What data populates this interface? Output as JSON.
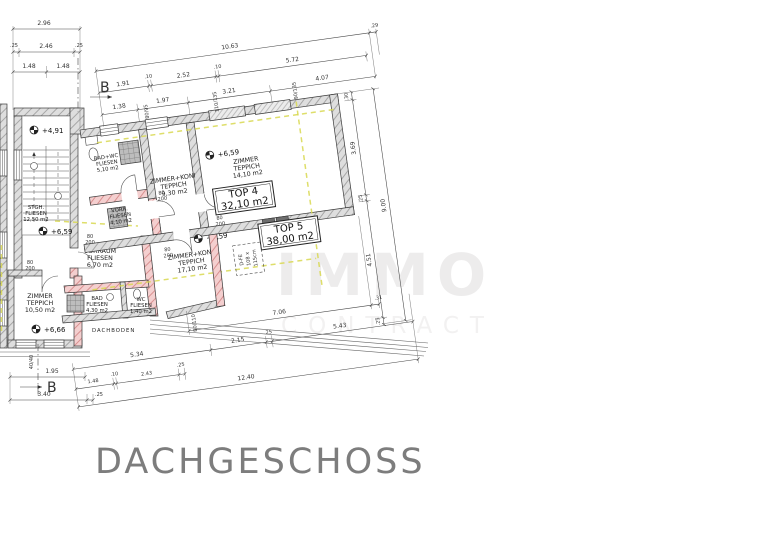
{
  "title": "DACHGESCHOSS",
  "watermark": {
    "line1": "IMMO",
    "line2": "CONTRACT"
  },
  "section_marker": "B",
  "tops": {
    "top4": {
      "label": "TOP 4",
      "area": "32,10 m2"
    },
    "top5": {
      "label": "TOP 5",
      "area": "38,00 m2"
    }
  },
  "rooms": {
    "stgh": [
      "STGH.",
      "FLIESEN",
      "12,50 m2"
    ],
    "badwc": [
      "BAD+WC",
      "FLIESEN",
      "5,10 m2"
    ],
    "zk930": [
      "ZIMMER+KONI",
      "TEPPICH",
      "9,30 m2"
    ],
    "z1410": [
      "ZIMMER",
      "TEPPICH",
      "14,10 m2"
    ],
    "vorr": [
      "VORR.",
      "FLIESEN",
      "4,10 m2"
    ],
    "vorraum": [
      "VORRAUM",
      "FLIESEN",
      "6,70 m2"
    ],
    "bad": [
      "BAD",
      "FLIESEN",
      "4,30 m2"
    ],
    "wc": [
      "WC",
      "FLIESEN",
      "1,40 m2"
    ],
    "z1050": [
      "ZIMMER",
      "TEPPICH",
      "10,50 m2"
    ],
    "zk1710": [
      "ZIMMER+KONI",
      "TEPPICH",
      "17,10 m2"
    ],
    "dachboden": "DACHBODEN"
  },
  "levels": {
    "l491": "+4,91",
    "l659": "+6,59",
    "l666": "+6,66"
  },
  "door_label": {
    "w": "80",
    "h": "200"
  },
  "roof_window": [
    "D-FE",
    "108 x",
    "115cm"
  ],
  "stacked": {
    "s1": "80/95",
    "s2": "110/135",
    "s3": "90/135",
    "s4": "80/110",
    "s5": "40/40"
  },
  "dims": {
    "tl1": "2.96",
    "tl2a": ".25",
    "tl2b": "2.46",
    "tl2c": ".25",
    "tl3a": "1.48",
    "tl3b": "1.48",
    "t1a": "10.63",
    "t1b": ".29",
    "t2": [
      "1.91",
      ".10",
      "2.52",
      ".10",
      "5.72"
    ],
    "t3": [
      "1.38",
      "1.97",
      "3.21",
      "4.07"
    ],
    "r1": [
      ".30",
      "3.69",
      ".25",
      "4.51",
      ".25"
    ],
    "r2": "9.00",
    "b1a": "7.06",
    "b1b": ".31",
    "b2": [
      "5.34",
      "2.15",
      ".25",
      "5.43"
    ],
    "b3": [
      "1.48",
      ".10",
      "2.43",
      ".25"
    ],
    "b4": "12.40",
    "lb1": "1.95",
    "lb2": "3.40",
    "lb3": ".25"
  }
}
